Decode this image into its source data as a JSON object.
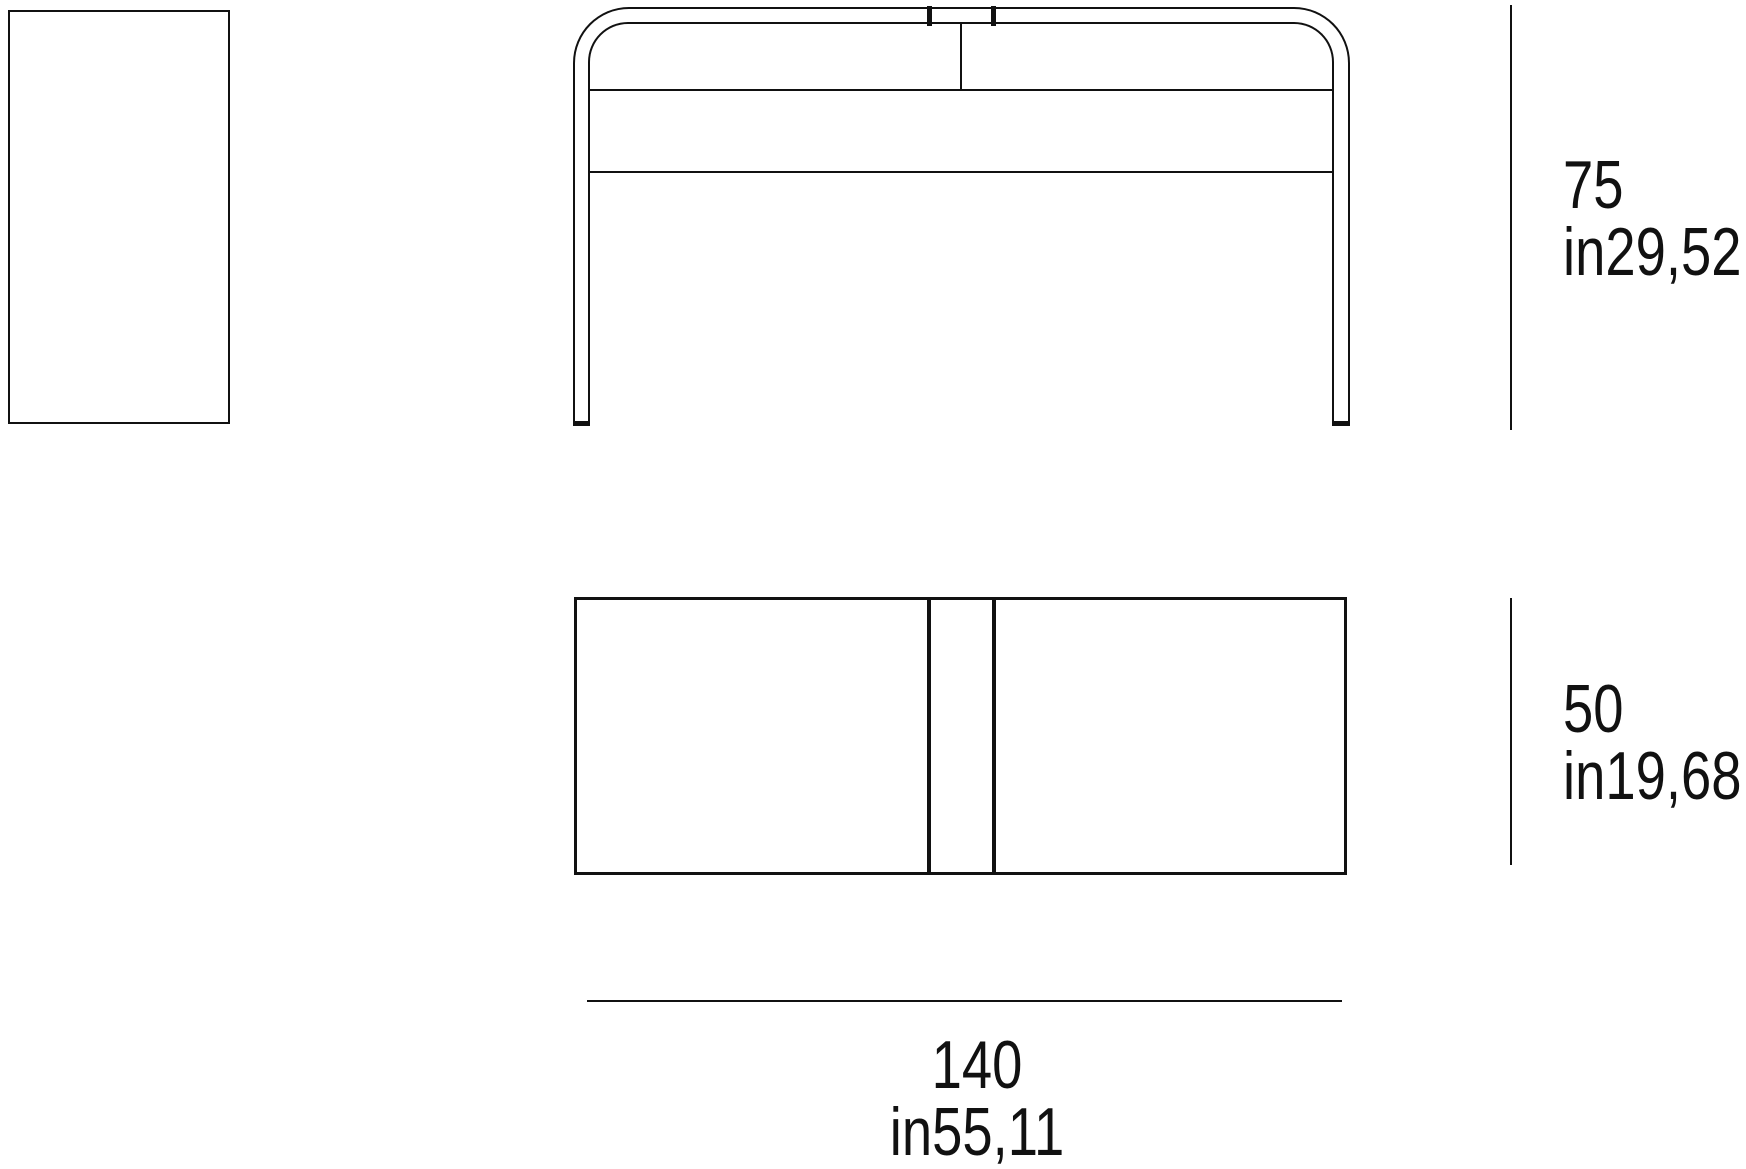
{
  "drawing": {
    "type": "furniture-dimension-diagram",
    "views": {
      "side_view": "side elevation",
      "front_view": "front elevation",
      "top_view": "plan view"
    }
  },
  "dimensions": {
    "height": {
      "cm": "75",
      "inches": "in29,52"
    },
    "depth": {
      "cm": "50",
      "inches": "in19,68"
    },
    "width": {
      "cm": "140",
      "inches": "in55,11"
    }
  },
  "colors": {
    "line": "#111111",
    "background": "#ffffff"
  }
}
